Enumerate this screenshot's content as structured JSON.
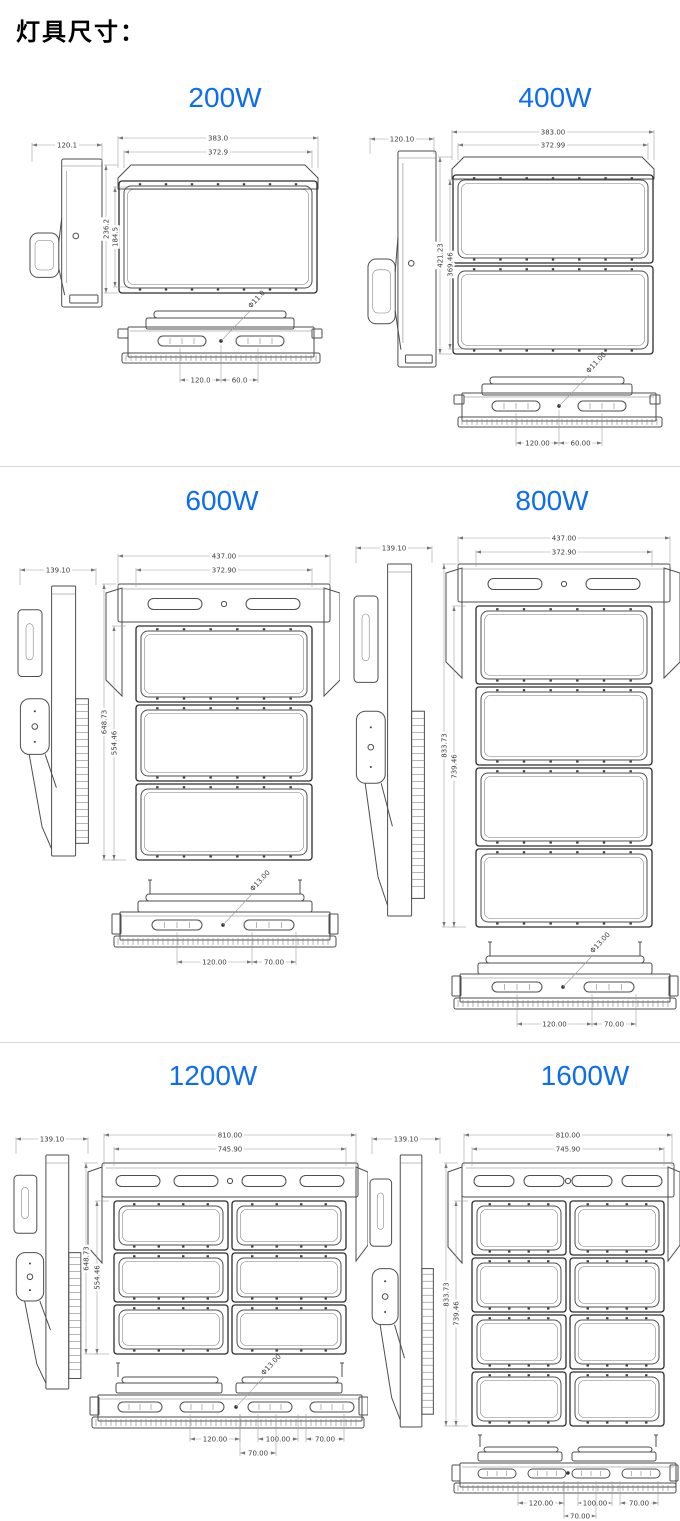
{
  "page": {
    "title": "灯具尺寸：",
    "accent_color": "#0c6cf2",
    "divider_color": "#dcdcdc",
    "background": "#ffffff"
  },
  "fixtures": [
    {
      "label": "200W",
      "rows": 1,
      "cols": 1,
      "dims": {
        "side_width": "120.1",
        "outer_width": "383.0",
        "inner_width": "372.9",
        "outer_height": "236.2",
        "inner_height": "184.5",
        "mount_hole": "Φ11.0",
        "bottom_spacings": [
          "120.0",
          "60.0"
        ]
      }
    },
    {
      "label": "400W",
      "rows": 2,
      "cols": 1,
      "dims": {
        "side_width": "120.10",
        "outer_width": "383.00",
        "inner_width": "372.99",
        "outer_height": "421.23",
        "inner_height": "369.46",
        "mount_hole": "Φ11.00",
        "bottom_spacings": [
          "120.00",
          "60.00"
        ]
      }
    },
    {
      "label": "600W",
      "rows": 3,
      "cols": 1,
      "dims": {
        "side_width": "139.10",
        "outer_width": "437.00",
        "inner_width": "372.90",
        "outer_height": "648.73",
        "inner_height": "554.46",
        "mount_hole": "Φ13.00",
        "bottom_spacings": [
          "120.00",
          "70.00"
        ]
      }
    },
    {
      "label": "800W",
      "rows": 4,
      "cols": 1,
      "dims": {
        "side_width": "139.10",
        "outer_width": "437.00",
        "inner_width": "372.90",
        "outer_height": "833.73",
        "inner_height": "739.46",
        "mount_hole": "Φ13.00",
        "bottom_spacings": [
          "120.00",
          "70.00"
        ]
      }
    },
    {
      "label": "1200W",
      "rows": 3,
      "cols": 2,
      "dims": {
        "side_width": "139.10",
        "outer_width": "810.00",
        "inner_width": "745.90",
        "outer_height": "648.73",
        "inner_height": "554.46",
        "mount_hole": "Φ13.00",
        "bottom_spacings": [
          "120.00",
          "100.00",
          "70.00",
          "70.00"
        ]
      }
    },
    {
      "label": "1600W",
      "rows": 4,
      "cols": 2,
      "dims": {
        "side_width": "139.10",
        "outer_width": "810.00",
        "inner_width": "745.90",
        "outer_height": "833.73",
        "inner_height": "739.46",
        "mount_hole": "",
        "bottom_spacings": [
          "120.00",
          "100.00",
          "70.00",
          "70.00"
        ]
      }
    }
  ]
}
